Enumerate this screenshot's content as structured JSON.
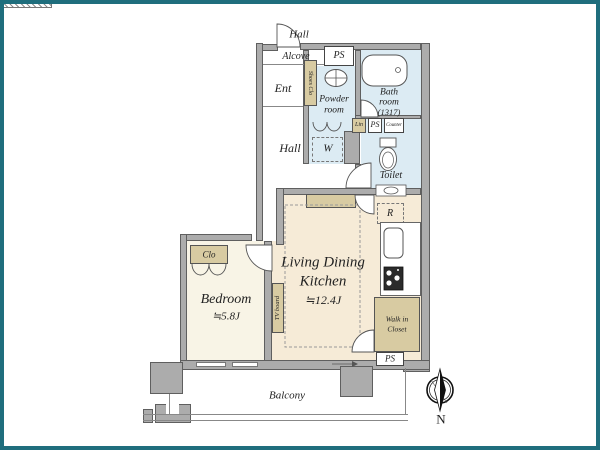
{
  "frame": {
    "border_color": "#1f6e7d"
  },
  "exterior": {
    "hall_label": "Hall",
    "balcony_label": "Balcony",
    "compass_label": "N"
  },
  "entry": {
    "alcove": "Alcove",
    "ps_top": "PS",
    "ent": "Ent",
    "shoes_clo": "Shoes Clo"
  },
  "hall": {
    "label": "Hall"
  },
  "sanitary": {
    "powder_line1": "Powder",
    "powder_line2": "room",
    "bath_line1": "Bath",
    "bath_line2": "room",
    "bath_line3": "(1317)",
    "lin": "Lin",
    "ps_mid": "PS",
    "counter": "Counter",
    "washer": "W",
    "toilet": "Toilet"
  },
  "ldk": {
    "line1": "Living Dining",
    "line2": "Kitchen",
    "size": "≒12.4J",
    "fridge": "R",
    "tv_board": "TV board",
    "walk_in_line1": "Walk in",
    "walk_in_line2": "Closet",
    "ps_bottom": "PS"
  },
  "bedroom": {
    "label": "Bedroom",
    "size": "≒5.8J",
    "closet": "Clo"
  },
  "colors": {
    "wall": "#acacac",
    "water_room": "#dcebf3",
    "ldk_floor": "#f6ebd7",
    "bedroom_floor": "#f8f4e6",
    "storage": "#d8cba2",
    "frame": "#1f6e7d"
  }
}
